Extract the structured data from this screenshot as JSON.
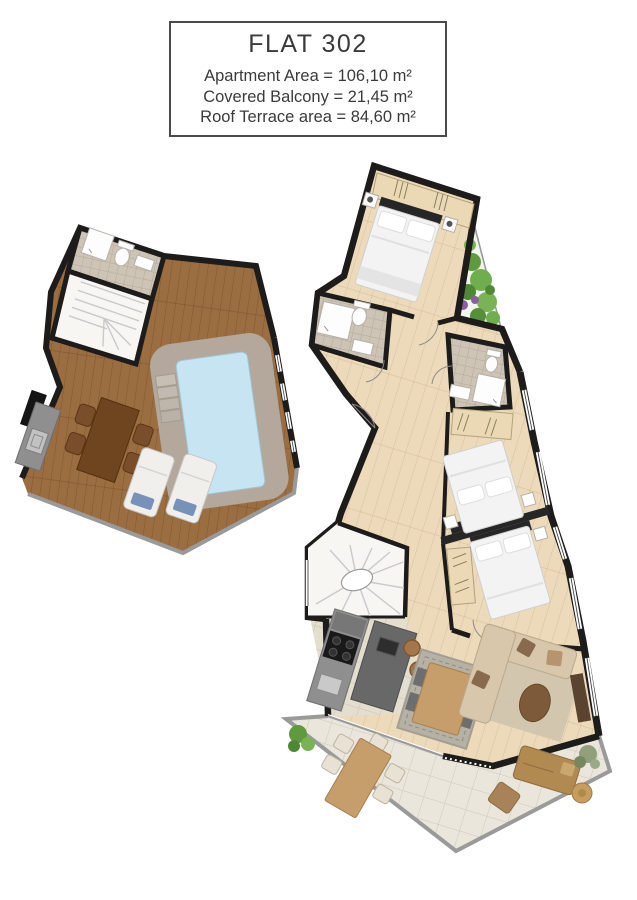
{
  "title_block": {
    "title": "FLAT 302",
    "lines": [
      "Apartment Area = 106,10 m²",
      "Covered Balcony = 21,45 m²",
      "Roof Terrace area = 84,60 m²"
    ]
  },
  "palette": {
    "wall": "#1d1c1a",
    "title_text": "#3b3b3b",
    "box_border": "#4a4a4a",
    "deck_wood": "#9b6e41",
    "apartment_floor": "#ecdaba",
    "kitchen_tile": "#e4decf",
    "balcony_tile": "#eae6dc",
    "pool_water": "#c6e4f2",
    "pool_surround": "#b3a89b",
    "bath_tile": "#cdc4b6",
    "stairs_white": "#f7f6f3",
    "garden_green": "#67a34b",
    "wardrobe_beige": "#ead9b4",
    "bed_white": "#f3f3f3",
    "headboard_dark": "#262626",
    "sofa_beige": "#d8c7aa",
    "rug_gray": "#b6b1a5",
    "rug_beige": "#cfc3ae",
    "counter_gray": "#8f8f8f",
    "island_gray": "#686868",
    "stool_brown": "#a5764a",
    "table_dark_wood": "#6f451f",
    "dining_wood": "#c59e6b",
    "tv_brown": "#5a4330",
    "daybed_brown": "#b18a52",
    "railing_gray": "#9a9a9a"
  }
}
